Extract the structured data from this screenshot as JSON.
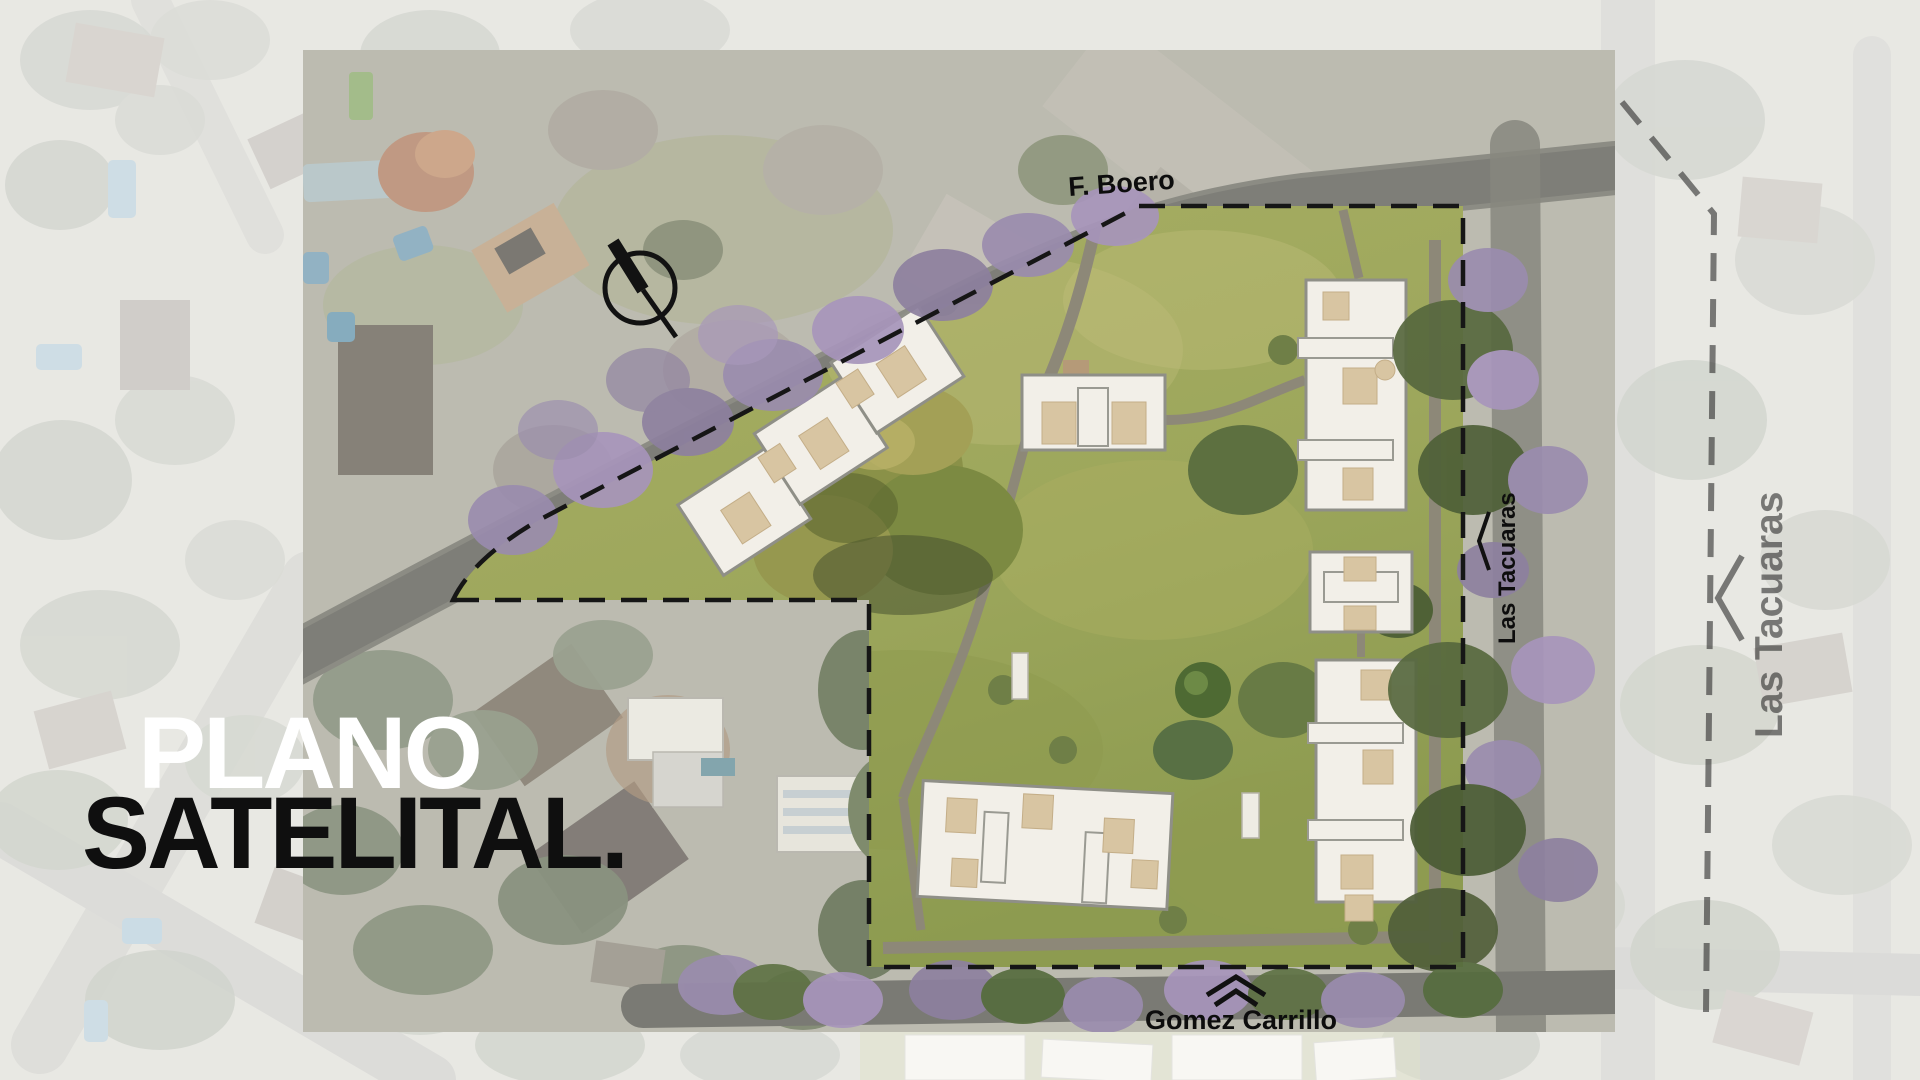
{
  "title": {
    "line1": "PLANO",
    "line2": "SATELITAL."
  },
  "map": {
    "street_top": "F. Boero",
    "street_right_inner": "Las Tacuaras",
    "street_right_outer": "Las Tacuaras",
    "street_bottom": "Gomez Carrillo"
  },
  "icons": {
    "north_arrow": "north-arrow-icon",
    "street_chevron_right": "street-direction-chevron-icon",
    "street_chevron_bottom": "street-direction-double-chevron-icon"
  },
  "colors": {
    "title_white": "#ffffff",
    "title_black": "#0f0f0f",
    "boundary_dash": "#161616",
    "lawn": "#9da75c",
    "building_fill": "#f2efe8",
    "roof_patch": "#d8c5a2",
    "jacaranda": "#9a8cae",
    "tree_dark": "#4e5c37",
    "road": "#5a5a52",
    "background_fade": "rgba(255,255,255,0.68)"
  }
}
